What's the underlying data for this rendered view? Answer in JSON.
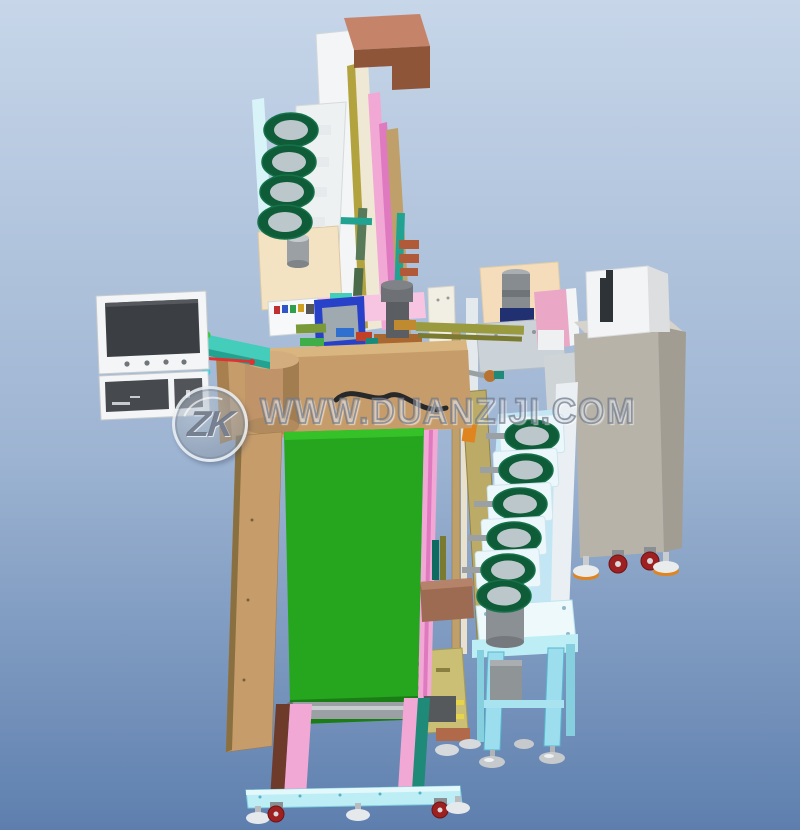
{
  "watermark": {
    "logo": "ZK",
    "text": "WWW.DUANZIJI.COM"
  },
  "scene": {
    "type": "3d-cad-render",
    "subject": "automatic terminal assembly machine line",
    "parts": [
      "vertical-tower-with-chute",
      "bowl-feeder-stack-left",
      "hmi-monitor-with-arm",
      "center-tooling-assembly",
      "press-station",
      "control-cabinet",
      "bowl-feeder-column-right",
      "feeder-stand-table",
      "machine-table",
      "green-belt-conveyor",
      "base-frame-with-casters"
    ]
  },
  "palette": {
    "bg_top": "#c7d6e9",
    "bg_bottom": "#5e7fae",
    "white_panel": "#f3f5f6",
    "screen_dark": "#3b3e42",
    "bowl_green": "#0f5c38",
    "bowl_rim": "#16724a",
    "bowl_inner": "#bcc7cb",
    "belt_green": "#26a51f",
    "belt_green_dark": "#1b7d15",
    "belt_highlight": "#34c228",
    "wood_tan": "#c69c6a",
    "wood_tan_dark": "#a8804f",
    "wood_top": "#d9b57f",
    "drum_tan": "#c09468",
    "cream": "#f3e3c2",
    "cream_panel": "#f5ddbb",
    "pink": "#f2a8d4",
    "pink_light": "#f7c4e2",
    "magenta": "#e07ac0",
    "olive": "#9a9a3e",
    "khaki": "#bcab66",
    "khaki_box": "#cabf74",
    "teal": "#45cdbb",
    "teal_dark": "#22a392",
    "deep_teal": "#1f8a78",
    "hmi_blue": "#2742c8",
    "navy": "#203070",
    "cabinet_gray": "#b7b3a8",
    "cabinet_side": "#a19d92",
    "cabinet_top": "#d5d3cb",
    "frame_cyan": "#9cdeed",
    "frame_cyan_light": "#bdeef5",
    "steel": "#9aa0a4",
    "steel_dark": "#55595c",
    "caster_red": "#9e2020",
    "orange": "#e0841f",
    "brown_top": "#c5846a",
    "brown_front": "#8f5538",
    "brown_block": "#9c6b52",
    "leg_brown": "#6e3b2b",
    "red_axis": "#e03030",
    "watermark_gray": "#7b8698"
  }
}
